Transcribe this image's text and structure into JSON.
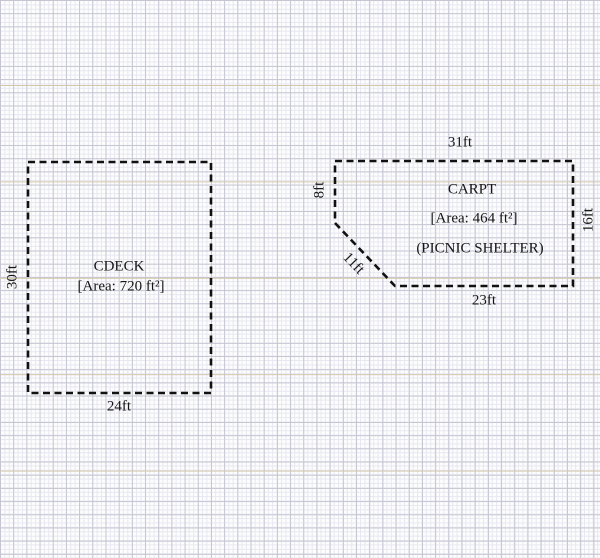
{
  "figure": {
    "title": "plot plan with two dashed shapes on graph paper",
    "shapes": [
      {
        "id": "cdeck",
        "name": "CDECK",
        "area_label": "[Area: 720 ft²]",
        "dims": {
          "left": "30ft",
          "bottom": "24ft"
        }
      },
      {
        "id": "carpt",
        "name": "CARPT",
        "area_label": "[Area: 464 ft²]",
        "note": "(PICNIC SHELTER)",
        "dims": {
          "top": "31ft",
          "left": "8ft",
          "diagonal": "11ft",
          "bottom": "23ft",
          "right": "16ft"
        }
      }
    ],
    "colors": {
      "outline": "#111111",
      "text": "#161616",
      "grid_minor": "#e7e7f0",
      "grid_major": "#c6c6d2",
      "grid_accent_rule": "#d3c7ab",
      "paper": "#fdfdfe"
    }
  }
}
